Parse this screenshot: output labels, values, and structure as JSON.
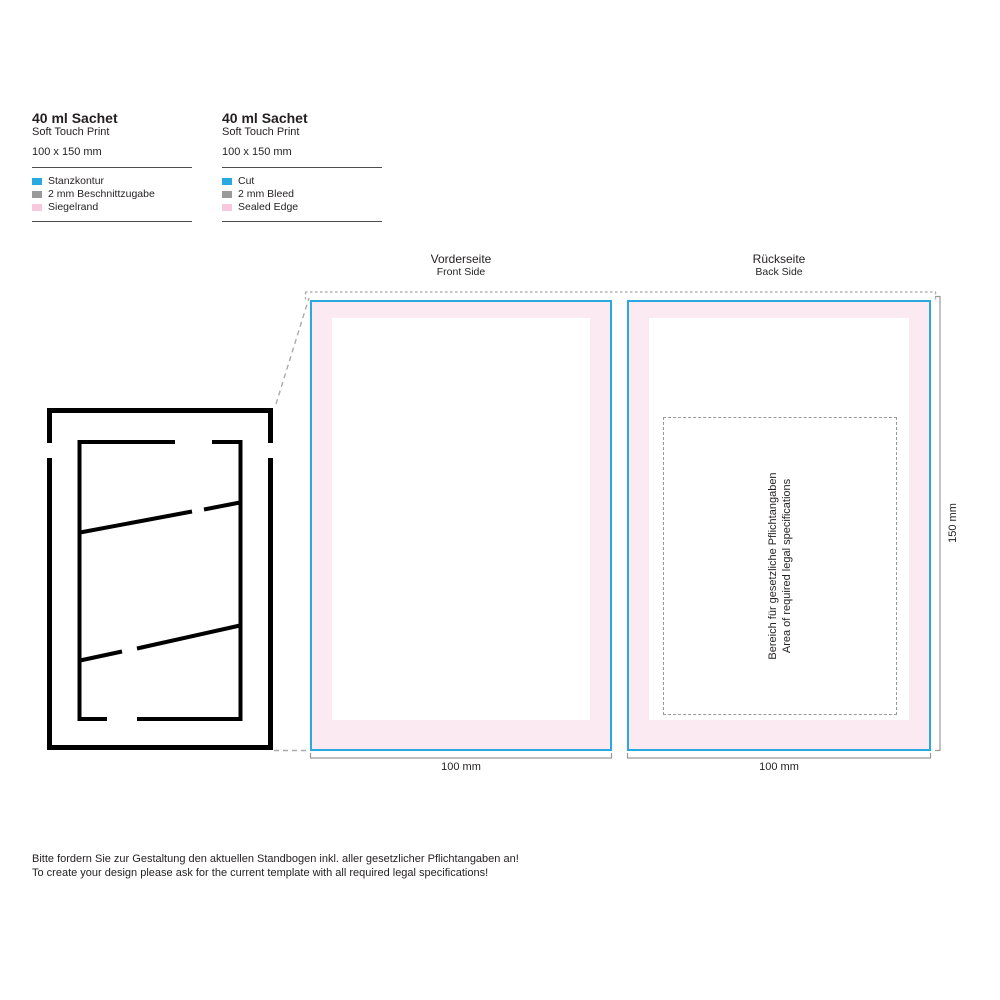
{
  "legend_de": {
    "title": "40 ml Sachet",
    "subtitle": "Soft Touch Print",
    "dimensions": "100 x 150 mm",
    "items": [
      {
        "label": "Stanzkontur",
        "color": "#29a9e0"
      },
      {
        "label": "2 mm Beschnittzugabe",
        "color": "#9a9a9a"
      },
      {
        "label": "Siegelrand",
        "color": "#f6c9dd"
      }
    ]
  },
  "legend_en": {
    "title": "40 ml Sachet",
    "subtitle": "Soft Touch Print",
    "dimensions": "100 x 150 mm",
    "items": [
      {
        "label": "Cut",
        "color": "#29a9e0"
      },
      {
        "label": "2 mm Bleed",
        "color": "#9a9a9a"
      },
      {
        "label": "Sealed Edge",
        "color": "#f6c9dd"
      }
    ]
  },
  "panels": {
    "front": {
      "label_de": "Vorderseite",
      "label_en": "Front Side",
      "width_label": "100 mm"
    },
    "back": {
      "label_de": "Rückseite",
      "label_en": "Back Side",
      "width_label": "100 mm",
      "legal_line_de": "Bereich für gesetzliche Pflichtangaben",
      "legal_line_en": "Area of required legal specifications"
    },
    "height_label": "150 mm"
  },
  "footer": {
    "line_de": "Bitte fordern Sie zur Gestaltung den aktuellen Standbogen inkl. aller gesetzlicher Pflichtangaben an!",
    "line_en": "To create your design please ask for the current template with all required legal specifications!"
  },
  "colors": {
    "blue": "#29a9e0",
    "sealed": "#fbeaf2",
    "gray_swatch": "#9a9a9a",
    "dash": "#b3b3b3",
    "dim": "#999999",
    "text": "#231f20",
    "die": "#000000"
  }
}
